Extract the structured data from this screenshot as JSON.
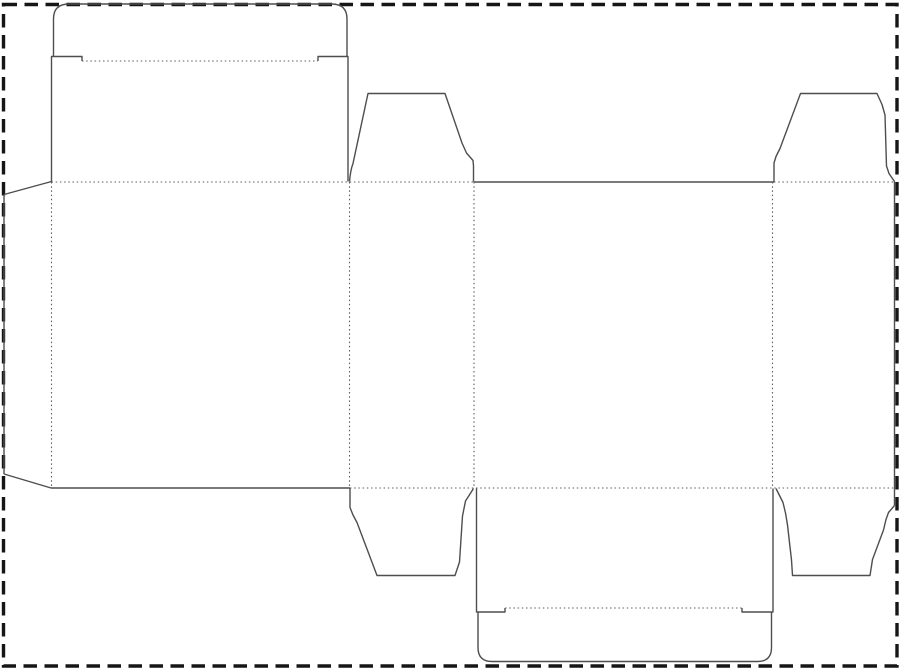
{
  "page": {
    "width": 900,
    "height": 669,
    "background_color": "#ffffff",
    "content_kind": "box-dieline-template"
  },
  "drawing": {
    "styles": {
      "cut": {
        "color": "#4e4e4e",
        "width": 1.4,
        "dash": ""
      },
      "fold": {
        "color": "#5d5d5d",
        "width": 1.1,
        "dash": "1.5 2.7"
      },
      "border": {
        "color": "#161616",
        "width": 3.4,
        "dash": "13.5 7.5"
      }
    },
    "paths": [
      {
        "name": "page-border",
        "kind": "border",
        "d": "M 3.5 4.5 L 897 4.5 L 897 666 L 3.5 666 Z"
      },
      {
        "name": "glue-tab-top-edge",
        "kind": "cut",
        "d": "M 51.5 181.5 L 4 194.5"
      },
      {
        "name": "glue-tab-left-edge",
        "kind": "cut",
        "d": "M 4 194.5 L 4 474"
      },
      {
        "name": "glue-tab-bottom-edge",
        "kind": "cut",
        "d": "M 4 474 L 51 488"
      },
      {
        "name": "top-lid-left-side",
        "kind": "cut",
        "d": "M 51.5 181.5 L 51.5 56.5 L 82 56.5 L 82 61"
      },
      {
        "name": "top-tuck-flap-outline",
        "kind": "cut",
        "d": "M 53.5 56.5 L 53.5 19 Q 53.5 4 69 4 L 331.5 4 Q 347 4 347 19 L 347 56.5"
      },
      {
        "name": "top-lid-right-side",
        "kind": "cut",
        "d": "M 318 61 L 318 56.5 L 348 56.5 L 348 181.5"
      },
      {
        "name": "top-dust-flap-left-outline",
        "kind": "cut",
        "d": "M 349.5 181.5 Q 350.5 170 353 163.5 L 368 93.5 L 445 93.5 L 462 143 L 466.5 153 L 473 160.5 L 473.5 166 L 473.5 181.5"
      },
      {
        "name": "back-panel-top-edge",
        "kind": "cut",
        "d": "M 473.5 182 L 774 182"
      },
      {
        "name": "top-dust-flap-right-outline",
        "kind": "cut",
        "d": "M 774 181.5 L 774 163 L 776 156.5 L 780 148.5 L 800.5 93.5 L 877 93.5 L 882 104.5 L 885 115 L 886.5 166 L 889 173.5 L 894.5 181.5"
      },
      {
        "name": "right-panel-outer-edge",
        "kind": "cut",
        "d": "M 894.5 181.5 L 894.5 505.5"
      },
      {
        "name": "bottom-dust-flap-right-outline",
        "kind": "cut",
        "d": "M 894.5 505.5 L 888.5 512.5 L 886 519.5 L 883.5 530 L 872.5 559.5 L 870 575.5 L 792.5 575.5 L 791.5 560 L 787.5 525 L 785.5 513 L 783 502.5 L 776 488.5"
      },
      {
        "name": "bottom-dust-flap-left-outline",
        "kind": "cut",
        "d": "M 350 488 L 350 507.5 L 353 515 L 357 522.5 L 377 575.5 L 455 575.5 L 459.5 562 L 462.5 516 L 465.5 501 L 473.5 488.5"
      },
      {
        "name": "front-panel-bottom-edge",
        "kind": "cut",
        "d": "M 51 488 L 350 488"
      },
      {
        "name": "bottom-lid-left-side",
        "kind": "cut",
        "d": "M 476.5 488.5 L 476.5 612 L 505 612 L 505 608"
      },
      {
        "name": "bottom-tuck-flap-outline",
        "kind": "cut",
        "d": "M 478 612 L 478 647.5 Q 478 661.5 492 661.5 L 757.5 661.5 Q 771.5 661.5 771.5 647.5 L 771.5 612"
      },
      {
        "name": "bottom-lid-right-side",
        "kind": "cut",
        "d": "M 742 608 L 742 612 L 773 612 L 773 488.5"
      },
      {
        "name": "top-tuck-fold",
        "kind": "fold",
        "d": "M 82 61 L 318 61"
      },
      {
        "name": "top-body-fold-left",
        "kind": "fold",
        "d": "M 51.5 182 L 473.5 182"
      },
      {
        "name": "top-body-fold-right",
        "kind": "fold",
        "d": "M 774 182 L 894 182"
      },
      {
        "name": "bottom-body-fold",
        "kind": "fold",
        "d": "M 350 488 L 894.5 488"
      },
      {
        "name": "bottom-tuck-fold",
        "kind": "fold",
        "d": "M 505 608 L 742 608"
      },
      {
        "name": "glue-tab-fold",
        "kind": "fold",
        "d": "M 51.5 182 L 51.5 488"
      },
      {
        "name": "front-side-panel-fold",
        "kind": "fold",
        "d": "M 349.5 182 L 349.5 488"
      },
      {
        "name": "side-back-panel-fold",
        "kind": "fold",
        "d": "M 474 182 L 474 488"
      },
      {
        "name": "back-side-panel-fold",
        "kind": "fold",
        "d": "M 772.5 182 L 772.5 488"
      }
    ]
  }
}
